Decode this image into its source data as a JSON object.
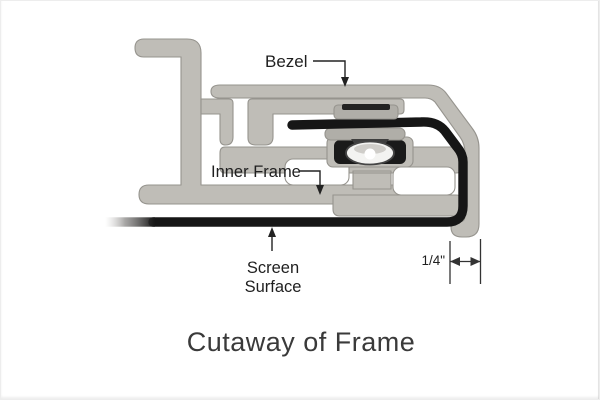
{
  "title": "Cutaway of Frame",
  "labels": {
    "bezel": "Bezel",
    "inner_frame": "Inner Frame",
    "screen_line1": "Screen",
    "screen_line2": "Surface",
    "dimension": "1/4\""
  },
  "colors": {
    "background": "#ffffff",
    "aluminum": "#bfbdb7",
    "aluminum_dark": "#b0aea8",
    "aluminum_edge": "#96948e",
    "screen_black": "#161616",
    "hardware_dark": "#1a1a1a",
    "roller_white": "#f3f3f1",
    "label_text": "#1f1f1f",
    "title_text": "#3a3a3a"
  }
}
